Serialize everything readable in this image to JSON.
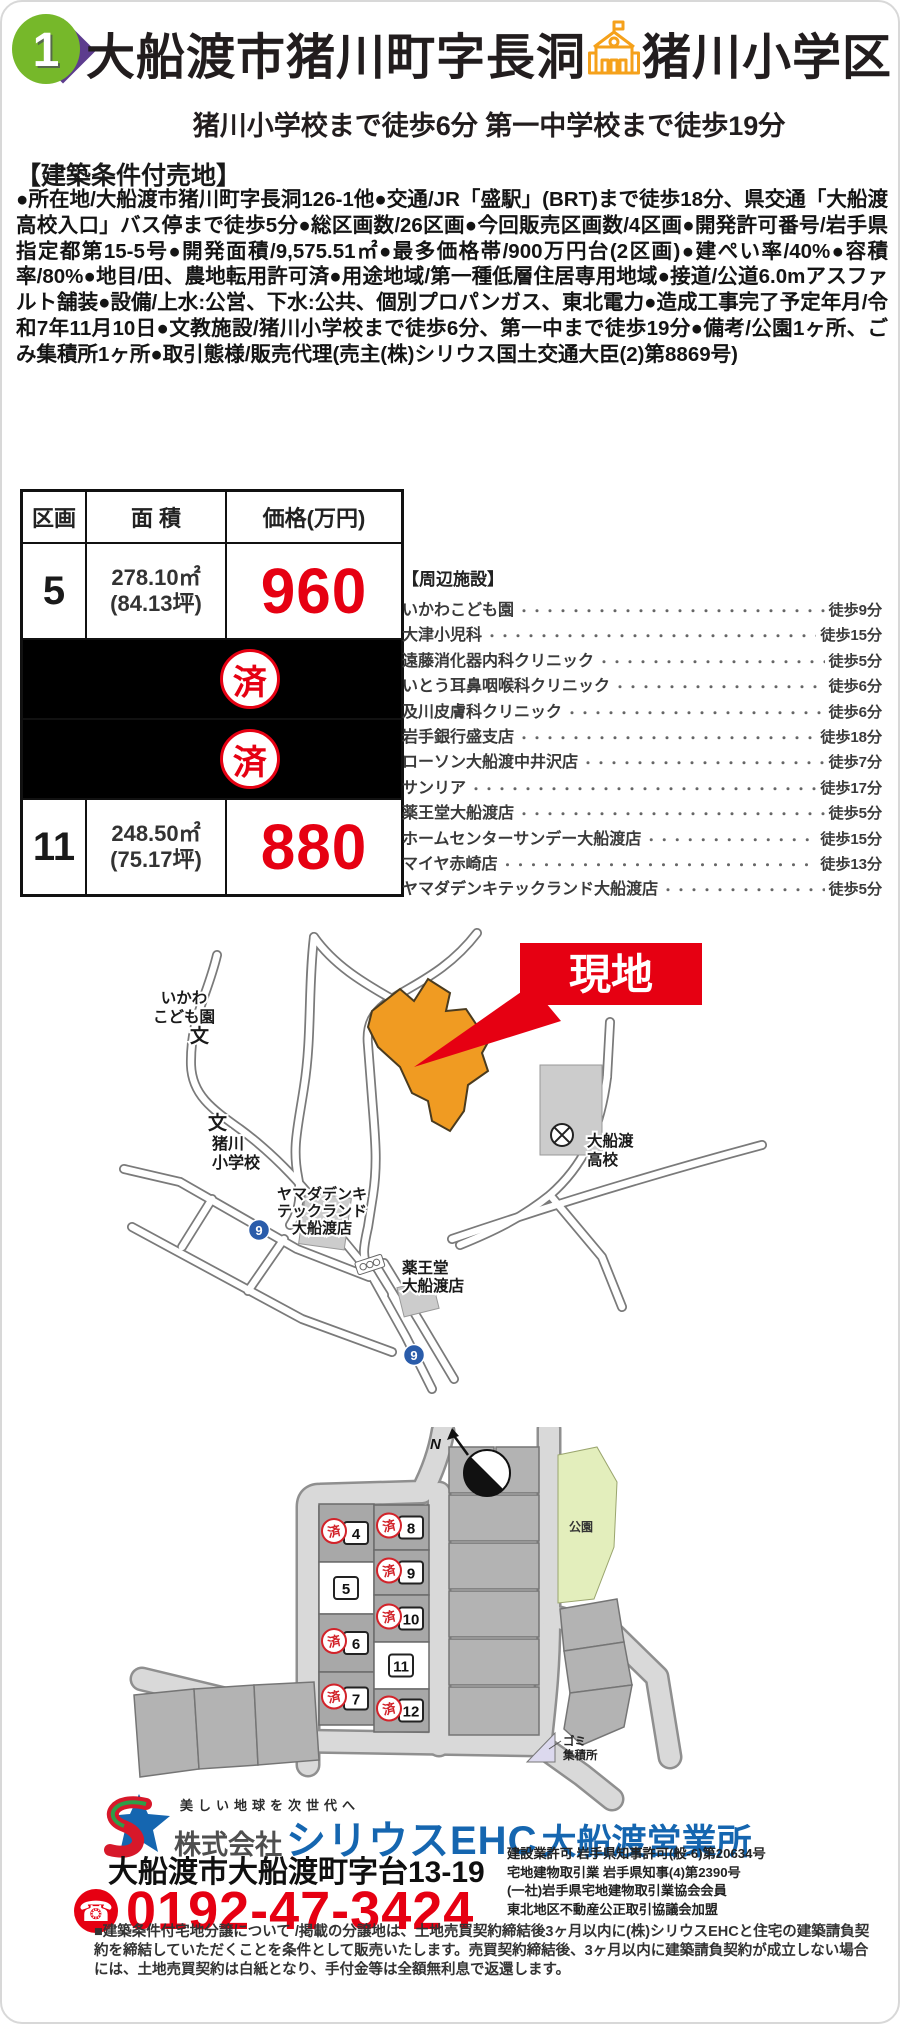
{
  "header": {
    "badge_number": "1",
    "title": "大船渡市猪川町字長洞",
    "school_zone": "猪川小学区",
    "subtitle": "猪川小学校まで徒歩6分 第一中学校まで徒歩19分"
  },
  "listing": {
    "heading": "【建築条件付売地】",
    "description": "●所在地/大船渡市猪川町字長洞126-1他●交通/JR「盛駅」(BRT)まで徒歩18分、県交通「大船渡高校入口」バス停まで徒歩5分●総区画数/26区画●今回販売区画数/4区画●開発許可番号/岩手県指定都第15-5号●開発面積/9,575.51㎡●最多価格帯/900万円台(2区画)●建ぺい率/40%●容積率/80%●地目/田、農地転用許可済●用途地域/第一種低層住居専用地域●接道/公道6.0mアスファルト舗装●設備/上水:公営、下水:公共、個別プロパンガス、東北電力●造成工事完了予定年月/令和7年11月10日●文教施設/猪川小学校まで徒歩6分、第一中まで徒歩19分●備考/公園1ヶ所、ごみ集積所1ヶ所●取引態様/販売代理(売主(株)シリウス国土交通大臣(2)第8869号)"
  },
  "table": {
    "headers": [
      "区画",
      "面 積",
      "価格(万円)"
    ],
    "sold_stamp": "済",
    "rows": [
      {
        "lot": "5",
        "area": "278.10㎡",
        "tsubo": "(84.13坪)",
        "price": "960",
        "sold": false
      },
      {
        "sold": true
      },
      {
        "sold": true
      },
      {
        "lot": "11",
        "area": "248.50㎡",
        "tsubo": "(75.17坪)",
        "price": "880",
        "sold": false
      }
    ]
  },
  "facilities": {
    "heading": "【周辺施設】",
    "items": [
      {
        "name": "いかわこども園",
        "time": "徒歩9分"
      },
      {
        "name": "大津小児科",
        "time": "徒歩15分"
      },
      {
        "name": "遠藤消化器内科クリニック",
        "time": "徒歩5分"
      },
      {
        "name": "いとう耳鼻咽喉科クリニック",
        "time": "徒歩6分"
      },
      {
        "name": "及川皮膚科クリニック",
        "time": "徒歩6分"
      },
      {
        "name": "岩手銀行盛支店",
        "time": "徒歩18分"
      },
      {
        "name": "ローソン大船渡中井沢店",
        "time": "徒歩7分"
      },
      {
        "name": "サンリア",
        "time": "徒歩17分"
      },
      {
        "name": "薬王堂大船渡店",
        "time": "徒歩5分"
      },
      {
        "name": "ホームセンターサンデー大船渡店",
        "time": "徒歩15分"
      },
      {
        "name": "マイヤ赤崎店",
        "time": "徒歩13分"
      },
      {
        "name": "ヤマダデンキテックランド大船渡店",
        "time": "徒歩5分"
      }
    ]
  },
  "map": {
    "genchi_flag": "現地",
    "route_number": "9",
    "school_symbol": "文",
    "labels": {
      "kodomoen": [
        "いかわ",
        "こども園"
      ],
      "elementary": [
        "猪川",
        "小学校"
      ],
      "yamada": [
        "ヤマダデンキ",
        "テックランド",
        "大船渡店"
      ],
      "yakuodo": [
        "薬王堂",
        "大船渡店"
      ],
      "highschool": [
        "大船渡",
        "高校"
      ]
    }
  },
  "site_plan": {
    "north_label": "N",
    "park_label": "公園",
    "garbage_label": [
      "ゴミ",
      "集積所"
    ],
    "sold_stamp": "済",
    "lots": [
      {
        "no": "4",
        "sold": true
      },
      {
        "no": "5",
        "sold": false
      },
      {
        "no": "6",
        "sold": true
      },
      {
        "no": "7",
        "sold": true
      },
      {
        "no": "8",
        "sold": true
      },
      {
        "no": "9",
        "sold": true
      },
      {
        "no": "10",
        "sold": true
      },
      {
        "no": "11",
        "sold": false
      },
      {
        "no": "12",
        "sold": true
      }
    ]
  },
  "footer": {
    "tagline": "美しい地球を次世代へ",
    "company_prefix": "株式会社",
    "company_name": "シリウスEHC",
    "company_branch": "大船渡営業所",
    "address": "大船渡市大船渡町字台13-19",
    "phone": "0192-47-3424",
    "licenses": [
      "建設業許可 岩手県知事許可(般-6)第20634号",
      "宅地建物取引業 岩手県知事(4)第2390号",
      "(一社)岩手県宅地建物取引業協会会員",
      "東北地区不動産公正取引協議会加盟"
    ],
    "disclaimer": "■建築条件付宅地分譲について /掲載の分譲地は、土地売買契約締結後3ヶ月以内に(株)シリウスEHCと住宅の建築請負契約を締結していただくことを条件として販売いたします。売買契約締結後、3ヶ月以内に建築請負契約が成立しない場合には、土地売買契約は白紙となり、手付金等は全額無利息で返還します。"
  },
  "colors": {
    "accent_red": "#e60012",
    "brand_blue": "#1566b0",
    "badge_green": "#76b82a",
    "badge_purple": "#5d3c8e",
    "site_orange": "#f09b22",
    "park_green": "#e3eebc"
  }
}
